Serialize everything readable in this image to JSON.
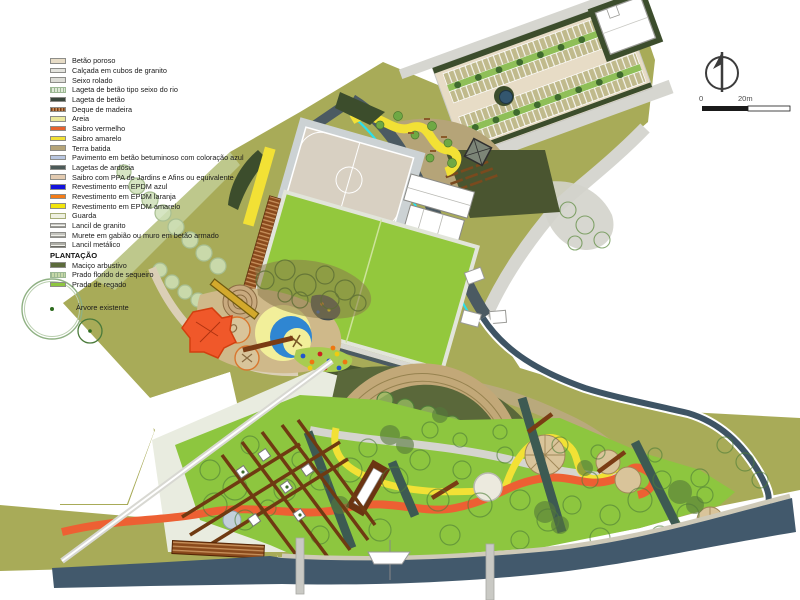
{
  "legend": {
    "materials": [
      {
        "label": "Betão poroso",
        "swatch": {
          "type": "solid",
          "color": "#e7dcc6"
        }
      },
      {
        "label": "Calçada em cubos de granito",
        "swatch": {
          "type": "solid",
          "color": "#e3e3dd"
        }
      },
      {
        "label": "Seixo rolado",
        "swatch": {
          "type": "solid",
          "color": "#dcdcd6"
        }
      },
      {
        "label": "Lageta de betão tipo seixo do rio",
        "swatch": {
          "type": "hatchv",
          "color": "#dfe9d8"
        }
      },
      {
        "label": "Lageta de betão",
        "swatch": {
          "type": "solid",
          "color": "#3a473d"
        }
      },
      {
        "label": "Deque de madeira",
        "swatch": {
          "type": "wood",
          "color": "#8a4a1c"
        }
      },
      {
        "label": "Areia",
        "swatch": {
          "type": "solid",
          "color": "#ebe89a"
        }
      },
      {
        "label": "Saibro vermelho",
        "swatch": {
          "type": "solid",
          "color": "#e8622d"
        }
      },
      {
        "label": "Saibro amarelo",
        "swatch": {
          "type": "solid",
          "color": "#f2e135"
        }
      },
      {
        "label": "Terra batida",
        "swatch": {
          "type": "solid",
          "color": "#b5a478"
        }
      },
      {
        "label": "Pavimento em betão betuminoso com coloração azul",
        "swatch": {
          "type": "solid",
          "color": "#b8c6e0"
        }
      },
      {
        "label": "Lagetas de ardósia",
        "swatch": {
          "type": "solid",
          "color": "#4c5a58"
        }
      },
      {
        "label": "Saibro com PPA de Jardins e Afins ou equivalente",
        "swatch": {
          "type": "solid",
          "color": "#e3cbb1"
        }
      },
      {
        "label": "Revestimento em EPDM azul",
        "swatch": {
          "type": "solid",
          "color": "#1313dc"
        }
      },
      {
        "label": "Revestimento em EPDM laranja",
        "swatch": {
          "type": "solid",
          "color": "#f57c17"
        }
      },
      {
        "label": "Revestimento em EPDM amarelo",
        "swatch": {
          "type": "solid",
          "color": "#f2e50c"
        }
      },
      {
        "label": "Guarda",
        "swatch": {
          "type": "guard",
          "color": "#eef0e0"
        }
      },
      {
        "label": "Lancil de granito",
        "swatch": {
          "type": "linesh",
          "color": "#f4f4ef"
        }
      },
      {
        "label": "Murete em gabião ou muro em betão armado",
        "swatch": {
          "type": "linesh",
          "color": "#efefe8"
        }
      },
      {
        "label": "Lancil metálico",
        "swatch": {
          "type": "darklines",
          "color": "#f1f1ea"
        }
      }
    ],
    "plantacao_header": "PLANTAÇÃO",
    "plantacao": [
      {
        "label": "Maciço arbustivo",
        "swatch": {
          "type": "solid",
          "color": "#5c6b3c"
        }
      },
      {
        "label": "Prado florido de sequeiro",
        "swatch": {
          "type": "hatchv",
          "color": "#c6d8a8"
        }
      },
      {
        "label": "Prado de regado",
        "swatch": {
          "type": "solid",
          "color": "#8dc63f"
        }
      }
    ],
    "tree_label": "Árvore existente"
  },
  "scalebar": {
    "zero": "0",
    "max": "20m"
  },
  "compass": {
    "icon": "north-arrow-icon"
  },
  "colors": {
    "olive_land": "#a8ab58",
    "lawn_green": "#8dc63f",
    "river": "#42596c",
    "slate_path": "#4b5a62",
    "cyan_edge": "#2ae0ee",
    "orange_path": "#ed6033",
    "yellow_path": "#f2e135",
    "epdm_blue": "#2f86d2",
    "wood": "#7a3c14",
    "dark_hedge": "#3c4d2c",
    "terra": "#b5a478",
    "pale_meadow": "#cfe0b8"
  }
}
